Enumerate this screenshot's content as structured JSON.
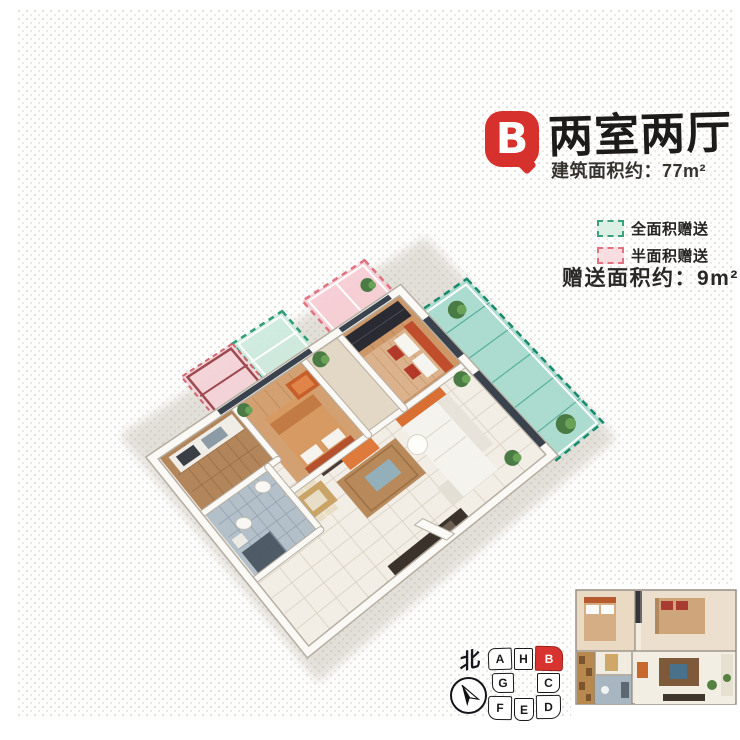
{
  "badge": {
    "letter": "B",
    "color": "#d6312d"
  },
  "header": {
    "title": "两室两厅",
    "subtitle": "建筑面积约：77m²"
  },
  "legend": {
    "items": [
      {
        "id": "full-area-gift",
        "label": "全面积赠送",
        "fill": "#ddf0e5",
        "stroke": "#3ba17d"
      },
      {
        "id": "half-area-gift",
        "label": "半面积赠送",
        "fill": "#f9dde1",
        "stroke": "#e0737d"
      }
    ]
  },
  "gift": {
    "text": "赠送面积约：9m²"
  },
  "compass": {
    "label": "北"
  },
  "key_plan": {
    "highlight_color": "#d8332f",
    "units": [
      {
        "id": "a",
        "label": "A",
        "highlighted": false
      },
      {
        "id": "h",
        "label": "H",
        "highlighted": false
      },
      {
        "id": "b",
        "label": "B",
        "highlighted": true
      },
      {
        "id": "g",
        "label": "G",
        "highlighted": false
      },
      {
        "id": "c",
        "label": "C",
        "highlighted": false
      },
      {
        "id": "f",
        "label": "F",
        "highlighted": false
      },
      {
        "id": "e",
        "label": "E",
        "highlighted": false
      },
      {
        "id": "d",
        "label": "D",
        "highlighted": false
      }
    ]
  },
  "colors": {
    "accent_red": "#d6312d",
    "full_gift_green": "#188a6b",
    "half_gift_pink": "#e0737d"
  }
}
